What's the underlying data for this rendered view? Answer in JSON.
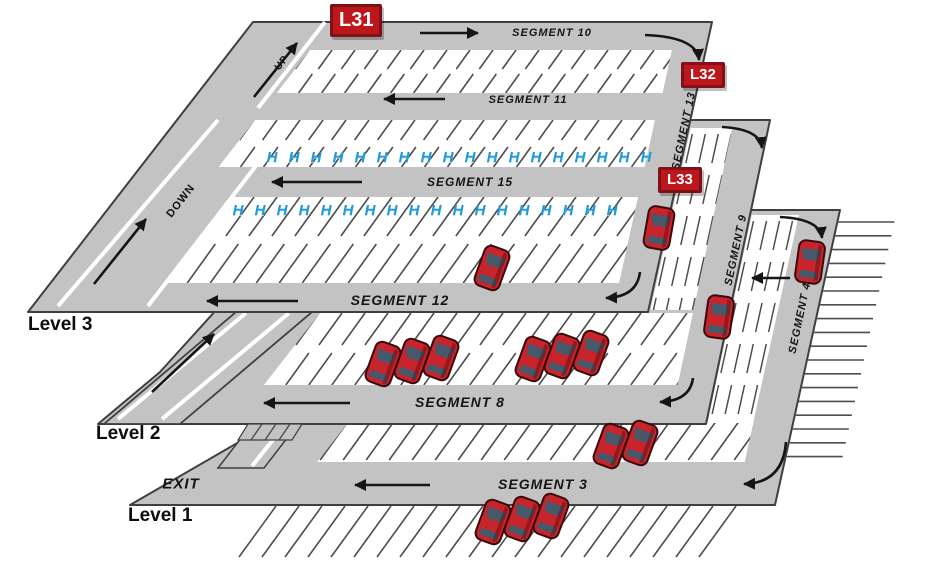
{
  "diagram": {
    "type": "multi-level parking structure map",
    "levels": [
      {
        "name": "Level 3",
        "segments": [
          "SEGMENT 10",
          "SEGMENT 11",
          "SEGMENT 15",
          "SEGMENT 12",
          "SEGMENT 13"
        ],
        "ramp_labels": [
          "UP",
          "DOWN"
        ],
        "location_badges": [
          "L31",
          "L32",
          "L33"
        ],
        "parked_cars": 2,
        "accessible_rows": 2
      },
      {
        "name": "Level 2",
        "segments": [
          "SEGMENT 8",
          "SEGMENT 9"
        ],
        "parked_cars": 7
      },
      {
        "name": "Level 1",
        "segments": [
          "SEGMENT 3",
          "SEGMENT 4"
        ],
        "exit_label": "EXIT",
        "parked_cars": 6
      }
    ]
  },
  "accessible_spaces": {
    "symbol": "H",
    "rows": [
      {
        "level": "Level 3",
        "count": 18
      },
      {
        "level": "Level 3",
        "count": 18
      }
    ]
  },
  "cars": [
    {
      "x": 659,
      "y": 228,
      "rot": 10
    },
    {
      "x": 492,
      "y": 268,
      "rot": 20
    },
    {
      "x": 383,
      "y": 364,
      "rot": 20
    },
    {
      "x": 412,
      "y": 361,
      "rot": 20
    },
    {
      "x": 441,
      "y": 358,
      "rot": 20
    },
    {
      "x": 533,
      "y": 359,
      "rot": 20
    },
    {
      "x": 562,
      "y": 356,
      "rot": 20
    },
    {
      "x": 591,
      "y": 353,
      "rot": 20
    },
    {
      "x": 719,
      "y": 317,
      "rot": 8
    },
    {
      "x": 810,
      "y": 262,
      "rot": 8
    },
    {
      "x": 611,
      "y": 446,
      "rot": 20
    },
    {
      "x": 640,
      "y": 443,
      "rot": 20
    },
    {
      "x": 493,
      "y": 522,
      "rot": 20
    },
    {
      "x": 522,
      "y": 519,
      "rot": 20
    },
    {
      "x": 551,
      "y": 516,
      "rot": 20
    }
  ],
  "colors": {
    "deck": "#C3C3C3",
    "outline": "#3F3F3F",
    "stall_line": "#4D4D4D",
    "accessible_blue": "#1F9AD6",
    "car_body": "#C8242B",
    "car_glass": "#46596B",
    "badge_fill": "#BE161D",
    "badge_border": "#7E1216",
    "arrow": "#151515"
  }
}
